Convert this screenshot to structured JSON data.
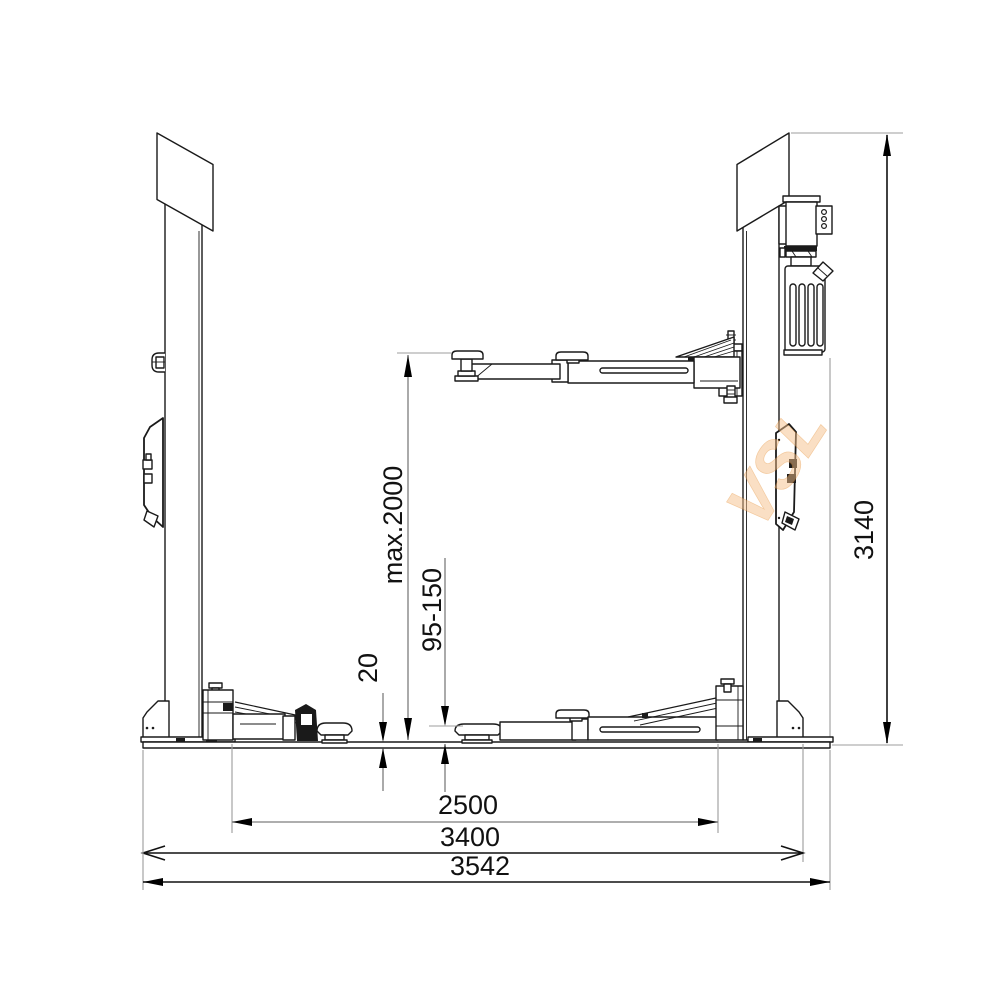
{
  "drawing_labels": {
    "max_lift_height": "max.2000",
    "pad_height_range": "95-150",
    "base_plate_thickness": "20",
    "clear_width": "2500",
    "post_outer_width": "3400",
    "overall_width": "3542",
    "overall_height": "3140"
  },
  "watermark": {
    "text": "VSL",
    "color": "#f0a85f"
  },
  "colors": {
    "line": "#1a1a1a",
    "dim_gray": "#7d7d7d",
    "background": "#ffffff"
  }
}
